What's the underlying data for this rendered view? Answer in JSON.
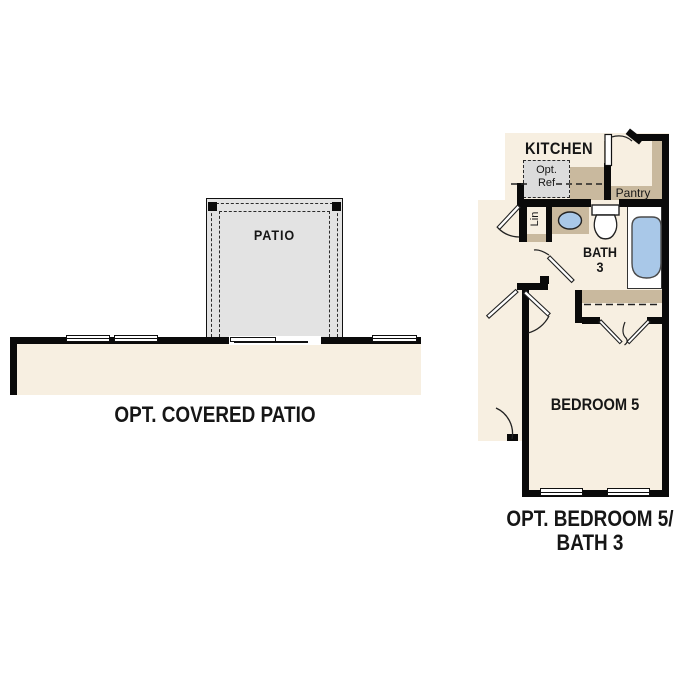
{
  "document": {
    "kind": "floor-plan-options-sheet"
  },
  "colors": {
    "wall": "#0a0a0a",
    "floor_cream": "#f7efe1",
    "cabinet_tan": "#c9b99e",
    "patio_gray": "#e3e3e3",
    "optional_item_gray": "#dcdcdc",
    "fixture_blue": "#a9c8e8",
    "text": "#1b1b1b"
  },
  "left_plan": {
    "title": "OPT. COVERED PATIO",
    "patio_label": "PATIO"
  },
  "right_plan": {
    "title_line1": "OPT. BEDROOM 5/",
    "title_line2": "BATH 3",
    "kitchen_label": "KITCHEN",
    "opt_ref_line1": "Opt.",
    "opt_ref_line2": "Ref",
    "pantry_label": "Pantry",
    "linen_label": "Lin",
    "bath_line1": "BATH",
    "bath_line2": "3",
    "bedroom_label": "BEDROOM 5"
  }
}
